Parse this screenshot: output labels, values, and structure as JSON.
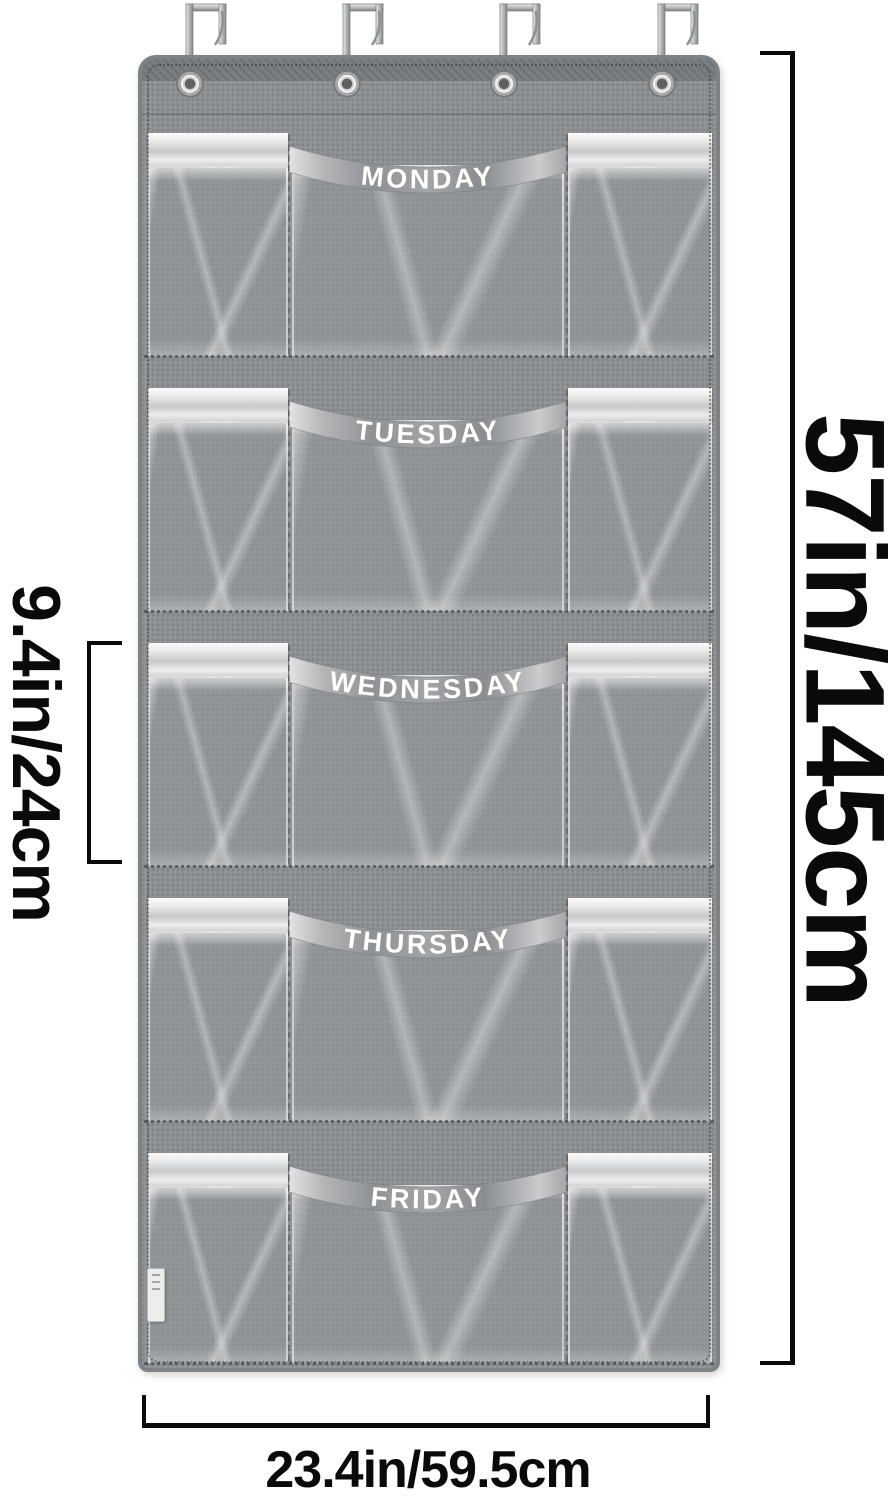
{
  "product": {
    "name": "over-door weekday hanging organizer",
    "days": [
      "MONDAY",
      "TUESDAY",
      "WEDNESDAY",
      "THURSDAY",
      "FRIDAY"
    ],
    "hook_count": 4,
    "pockets_per_row": 3
  },
  "annotations": {
    "height": "57in/145cm",
    "row_height": "9.4in/24cm",
    "width": "23.4in/59.5cm"
  },
  "colors": {
    "background": "#ffffff",
    "fabric": "#8d9092",
    "fabric_dark": "#7b7e81",
    "satin_trim": "#eceded",
    "band_satin": "#9b9ea1",
    "vinyl_highlight": "#e9eaeb",
    "metal": "#c2c4c6",
    "annotation": "#0a0a0a"
  }
}
